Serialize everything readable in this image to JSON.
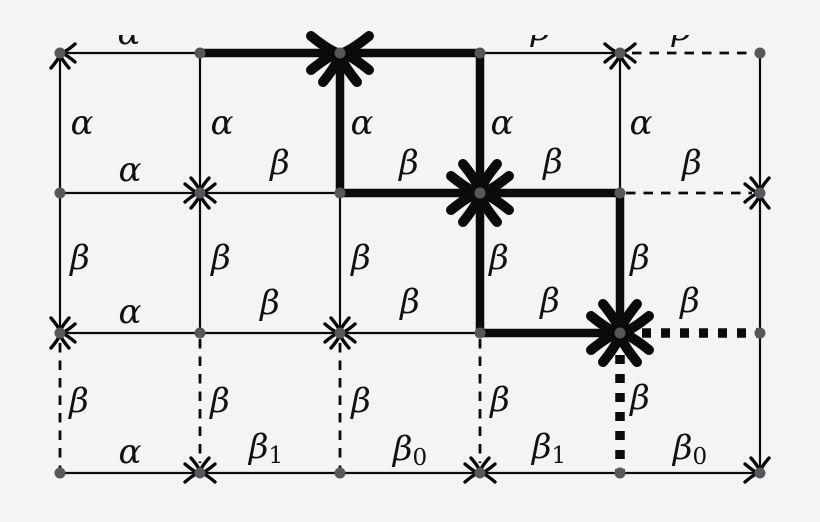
{
  "diagram": {
    "background": "#f5f4f2",
    "line_color": "#0b0b0b",
    "node_color": "#57575b",
    "label_color": "#111111",
    "width": 820,
    "height": 522,
    "grid": {
      "cols": [
        60,
        200,
        340,
        480,
        620,
        760
      ],
      "rows": [
        53,
        193,
        333,
        473
      ]
    },
    "edges": [
      {
        "x1": 60,
        "y1": 53,
        "x2": 200,
        "y2": 53,
        "style": "thin"
      },
      {
        "x1": 200,
        "y1": 53,
        "x2": 340,
        "y2": 53,
        "style": "thick"
      },
      {
        "x1": 340,
        "y1": 53,
        "x2": 480,
        "y2": 53,
        "style": "thick"
      },
      {
        "x1": 480,
        "y1": 53,
        "x2": 620,
        "y2": 53,
        "style": "thin"
      },
      {
        "x1": 620,
        "y1": 53,
        "x2": 760,
        "y2": 53,
        "style": "dashed",
        "t1": 12,
        "t2": 4
      },
      {
        "x1": 60,
        "y1": 193,
        "x2": 200,
        "y2": 193,
        "style": "thin"
      },
      {
        "x1": 200,
        "y1": 193,
        "x2": 340,
        "y2": 193,
        "style": "thin"
      },
      {
        "x1": 340,
        "y1": 193,
        "x2": 480,
        "y2": 193,
        "style": "thick"
      },
      {
        "x1": 480,
        "y1": 193,
        "x2": 620,
        "y2": 193,
        "style": "thick"
      },
      {
        "x1": 620,
        "y1": 193,
        "x2": 760,
        "y2": 193,
        "style": "dashed",
        "t1": 6,
        "t2": 8
      },
      {
        "x1": 60,
        "y1": 333,
        "x2": 200,
        "y2": 333,
        "style": "thin"
      },
      {
        "x1": 200,
        "y1": 333,
        "x2": 340,
        "y2": 333,
        "style": "thin"
      },
      {
        "x1": 340,
        "y1": 333,
        "x2": 480,
        "y2": 333,
        "style": "thin"
      },
      {
        "x1": 480,
        "y1": 333,
        "x2": 620,
        "y2": 333,
        "style": "thick"
      },
      {
        "x1": 620,
        "y1": 333,
        "x2": 760,
        "y2": 333,
        "style": "dotted-thick",
        "t1": 22,
        "t2": 2
      },
      {
        "x1": 60,
        "y1": 473,
        "x2": 200,
        "y2": 473,
        "style": "thin"
      },
      {
        "x1": 200,
        "y1": 473,
        "x2": 340,
        "y2": 473,
        "style": "thin"
      },
      {
        "x1": 340,
        "y1": 473,
        "x2": 480,
        "y2": 473,
        "style": "thin"
      },
      {
        "x1": 480,
        "y1": 473,
        "x2": 620,
        "y2": 473,
        "style": "thin"
      },
      {
        "x1": 620,
        "y1": 473,
        "x2": 760,
        "y2": 473,
        "style": "thin"
      },
      {
        "x1": 60,
        "y1": 53,
        "x2": 60,
        "y2": 193,
        "style": "thin"
      },
      {
        "x1": 60,
        "y1": 193,
        "x2": 60,
        "y2": 333,
        "style": "thin"
      },
      {
        "x1": 60,
        "y1": 333,
        "x2": 60,
        "y2": 473,
        "style": "dashed",
        "t1": 10,
        "t2": 4
      },
      {
        "x1": 200,
        "y1": 53,
        "x2": 200,
        "y2": 193,
        "style": "thin"
      },
      {
        "x1": 200,
        "y1": 193,
        "x2": 200,
        "y2": 333,
        "style": "thin"
      },
      {
        "x1": 200,
        "y1": 333,
        "x2": 200,
        "y2": 473,
        "style": "dashed",
        "t1": 6,
        "t2": 10
      },
      {
        "x1": 340,
        "y1": 53,
        "x2": 340,
        "y2": 193,
        "style": "thick"
      },
      {
        "x1": 340,
        "y1": 193,
        "x2": 340,
        "y2": 333,
        "style": "thin"
      },
      {
        "x1": 340,
        "y1": 333,
        "x2": 340,
        "y2": 473,
        "style": "dashed",
        "t1": 10,
        "t2": 4
      },
      {
        "x1": 480,
        "y1": 53,
        "x2": 480,
        "y2": 193,
        "style": "thick"
      },
      {
        "x1": 480,
        "y1": 193,
        "x2": 480,
        "y2": 333,
        "style": "thick"
      },
      {
        "x1": 480,
        "y1": 333,
        "x2": 480,
        "y2": 473,
        "style": "dashed",
        "t1": 6,
        "t2": 10
      },
      {
        "x1": 620,
        "y1": 53,
        "x2": 620,
        "y2": 193,
        "style": "thin"
      },
      {
        "x1": 620,
        "y1": 193,
        "x2": 620,
        "y2": 333,
        "style": "thick"
      },
      {
        "x1": 620,
        "y1": 333,
        "x2": 620,
        "y2": 473,
        "style": "dotted-thick",
        "t1": 22,
        "t2": 2
      },
      {
        "x1": 760,
        "y1": 53,
        "x2": 760,
        "y2": 193,
        "style": "thin"
      },
      {
        "x1": 760,
        "y1": 193,
        "x2": 760,
        "y2": 333,
        "style": "thin"
      },
      {
        "x1": 760,
        "y1": 333,
        "x2": 760,
        "y2": 473,
        "style": "thin"
      }
    ],
    "arrows": [
      {
        "x": 60,
        "y": 53,
        "dir": "left",
        "size": "small"
      },
      {
        "x": 60,
        "y": 53,
        "dir": "up",
        "size": "small"
      },
      {
        "x": 620,
        "y": 53,
        "dir": "right",
        "size": "small"
      },
      {
        "x": 620,
        "y": 53,
        "dir": "left",
        "size": "small"
      },
      {
        "x": 620,
        "y": 53,
        "dir": "up",
        "size": "small"
      },
      {
        "x": 200,
        "y": 193,
        "dir": "down",
        "size": "small"
      },
      {
        "x": 200,
        "y": 193,
        "dir": "right",
        "size": "small"
      },
      {
        "x": 200,
        "y": 193,
        "dir": "left",
        "size": "small"
      },
      {
        "x": 200,
        "y": 193,
        "dir": "up",
        "size": "small"
      },
      {
        "x": 760,
        "y": 193,
        "dir": "right",
        "size": "small"
      },
      {
        "x": 760,
        "y": 193,
        "dir": "down",
        "size": "small"
      },
      {
        "x": 760,
        "y": 193,
        "dir": "up",
        "size": "small"
      },
      {
        "x": 60,
        "y": 333,
        "dir": "down",
        "size": "small"
      },
      {
        "x": 60,
        "y": 333,
        "dir": "left",
        "size": "small"
      },
      {
        "x": 60,
        "y": 333,
        "dir": "up",
        "size": "small"
      },
      {
        "x": 340,
        "y": 333,
        "dir": "down",
        "size": "small"
      },
      {
        "x": 340,
        "y": 333,
        "dir": "right",
        "size": "small"
      },
      {
        "x": 340,
        "y": 333,
        "dir": "left",
        "size": "small"
      },
      {
        "x": 340,
        "y": 333,
        "dir": "up",
        "size": "small"
      },
      {
        "x": 200,
        "y": 473,
        "dir": "right",
        "size": "small"
      },
      {
        "x": 200,
        "y": 473,
        "dir": "left",
        "size": "small"
      },
      {
        "x": 200,
        "y": 473,
        "dir": "down",
        "size": "small"
      },
      {
        "x": 480,
        "y": 473,
        "dir": "right",
        "size": "small"
      },
      {
        "x": 480,
        "y": 473,
        "dir": "left",
        "size": "small"
      },
      {
        "x": 480,
        "y": 473,
        "dir": "down",
        "size": "small"
      },
      {
        "x": 760,
        "y": 473,
        "dir": "right",
        "size": "small"
      },
      {
        "x": 760,
        "y": 473,
        "dir": "down",
        "size": "small"
      },
      {
        "x": 340,
        "y": 53,
        "dir": "right",
        "size": "large"
      },
      {
        "x": 340,
        "y": 53,
        "dir": "left",
        "size": "large"
      },
      {
        "x": 340,
        "y": 53,
        "dir": "up",
        "size": "large"
      },
      {
        "x": 480,
        "y": 193,
        "dir": "down",
        "size": "large"
      },
      {
        "x": 480,
        "y": 193,
        "dir": "right",
        "size": "large"
      },
      {
        "x": 480,
        "y": 193,
        "dir": "left",
        "size": "large"
      },
      {
        "x": 480,
        "y": 193,
        "dir": "up",
        "size": "large"
      },
      {
        "x": 620,
        "y": 333,
        "dir": "down",
        "size": "large"
      },
      {
        "x": 620,
        "y": 333,
        "dir": "right",
        "size": "large"
      },
      {
        "x": 620,
        "y": 333,
        "dir": "left",
        "size": "large"
      },
      {
        "x": 620,
        "y": 333,
        "dir": "up",
        "size": "large"
      }
    ],
    "labels": [
      {
        "kind": "alpha",
        "text": "α",
        "x": 82,
        "y": 123
      },
      {
        "kind": "alpha",
        "text": "α",
        "x": 222,
        "y": 123
      },
      {
        "kind": "alpha",
        "text": "α",
        "x": 362,
        "y": 123
      },
      {
        "kind": "alpha",
        "text": "α",
        "x": 502,
        "y": 123
      },
      {
        "kind": "alpha",
        "text": "α",
        "x": 641,
        "y": 123
      },
      {
        "kind": "beta",
        "text": "β",
        "x": 80,
        "y": 258
      },
      {
        "kind": "beta",
        "text": "β",
        "x": 221,
        "y": 258
      },
      {
        "kind": "beta",
        "text": "β",
        "x": 361,
        "y": 258
      },
      {
        "kind": "beta",
        "text": "β",
        "x": 499,
        "y": 258
      },
      {
        "kind": "beta",
        "text": "β",
        "x": 640,
        "y": 258
      },
      {
        "kind": "beta",
        "text": "β",
        "x": 79,
        "y": 401
      },
      {
        "kind": "beta",
        "text": "β",
        "x": 220,
        "y": 401
      },
      {
        "kind": "beta",
        "text": "β",
        "x": 361,
        "y": 401
      },
      {
        "kind": "beta",
        "text": "β",
        "x": 500,
        "y": 400
      },
      {
        "kind": "beta",
        "text": "β",
        "x": 640,
        "y": 398
      },
      {
        "kind": "alpha",
        "text": "α",
        "x": 130,
        "y": 170
      },
      {
        "kind": "beta",
        "text": "β",
        "x": 280,
        "y": 163
      },
      {
        "kind": "beta",
        "text": "β",
        "x": 409,
        "y": 163
      },
      {
        "kind": "beta",
        "text": "β",
        "x": 553,
        "y": 162
      },
      {
        "kind": "beta",
        "text": "β",
        "x": 692,
        "y": 163
      },
      {
        "kind": "alpha",
        "text": "α",
        "x": 130,
        "y": 312
      },
      {
        "kind": "beta",
        "text": "β",
        "x": 270,
        "y": 303
      },
      {
        "kind": "beta",
        "text": "β",
        "x": 410,
        "y": 302
      },
      {
        "kind": "beta",
        "text": "β",
        "x": 550,
        "y": 301
      },
      {
        "kind": "beta",
        "text": "β",
        "x": 690,
        "y": 301
      },
      {
        "kind": "alpha",
        "text": "α",
        "x": 130,
        "y": 452
      },
      {
        "kind": "beta-1",
        "text": "β",
        "sub": "1",
        "x": 266,
        "y": 447
      },
      {
        "kind": "beta-0",
        "text": "β",
        "sub": "0",
        "x": 410,
        "y": 449
      },
      {
        "kind": "beta-1",
        "text": "β",
        "sub": "1",
        "x": 549,
        "y": 447
      },
      {
        "kind": "beta-0",
        "text": "β",
        "sub": "0",
        "x": 690,
        "y": 448
      }
    ],
    "clipped_labels": [
      {
        "kind": "alpha-partial",
        "text": "α",
        "x": 129,
        "y": 33
      },
      {
        "kind": "beta-partial",
        "text": "β",
        "x": 541,
        "y": 29
      },
      {
        "kind": "beta-partial",
        "text": "β",
        "x": 682,
        "y": 29
      }
    ]
  }
}
